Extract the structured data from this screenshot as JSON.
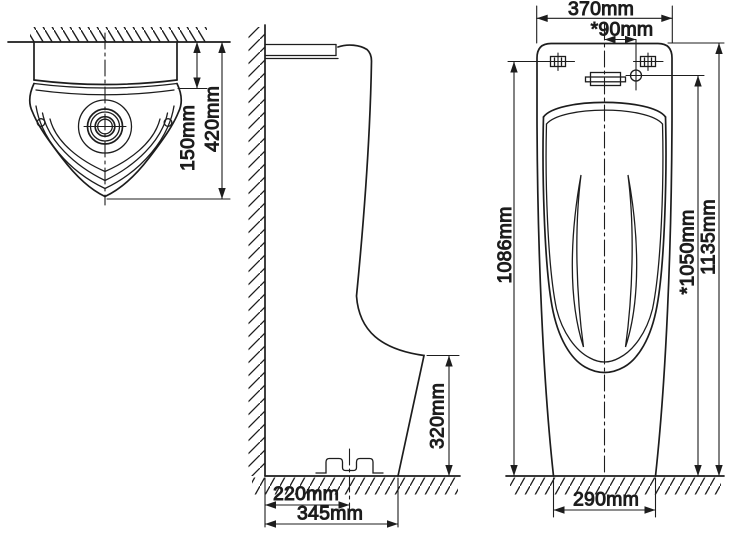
{
  "drawing": {
    "background_color": "#ffffff",
    "line_color": "#1d1d1d",
    "top_view": {
      "depth_to_rim": "150mm",
      "total_depth": "420mm"
    },
    "side_view": {
      "bowl_lip_height": "320mm",
      "drain_offset": "220mm",
      "base_depth": "345mm"
    },
    "front_view": {
      "overall_width": "370mm",
      "inlet_offset": "*90mm",
      "mount_hole_height": "1086mm",
      "inlet_height": "*1050mm",
      "overall_height": "1135mm",
      "base_width": "290mm"
    }
  }
}
